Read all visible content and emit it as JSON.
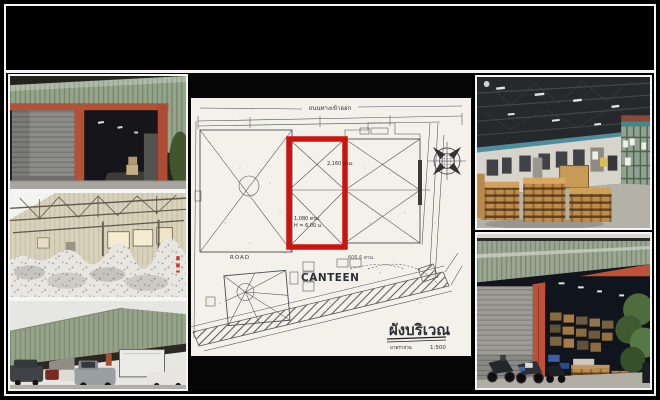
{
  "colors": {
    "canvas_bg": "#000000",
    "frame_border": "#f5f5f5",
    "plan_paper": "#f3f1ea",
    "plan_ink": "#4a4f57",
    "plan_highlight": "#cc140e",
    "warehouse_green": "#95a58c",
    "door_frame_orange": "#b85136",
    "pallet_wood": "#c08a48"
  },
  "site_plan": {
    "road_top_label": "ถนนทางเข้าออก",
    "title": "ผังบริเวณ",
    "scale_label": "มาตราส่วน",
    "scale_value": "1:500",
    "labels": {
      "building_area": "2,160 ตรม.",
      "unit_area": "1,080 ตรม.",
      "unit_height": "H = 6.00 ม.",
      "canteen_area": "606.6 ตรม.",
      "canteen": "CANTEEN",
      "road": "ROAD"
    }
  }
}
